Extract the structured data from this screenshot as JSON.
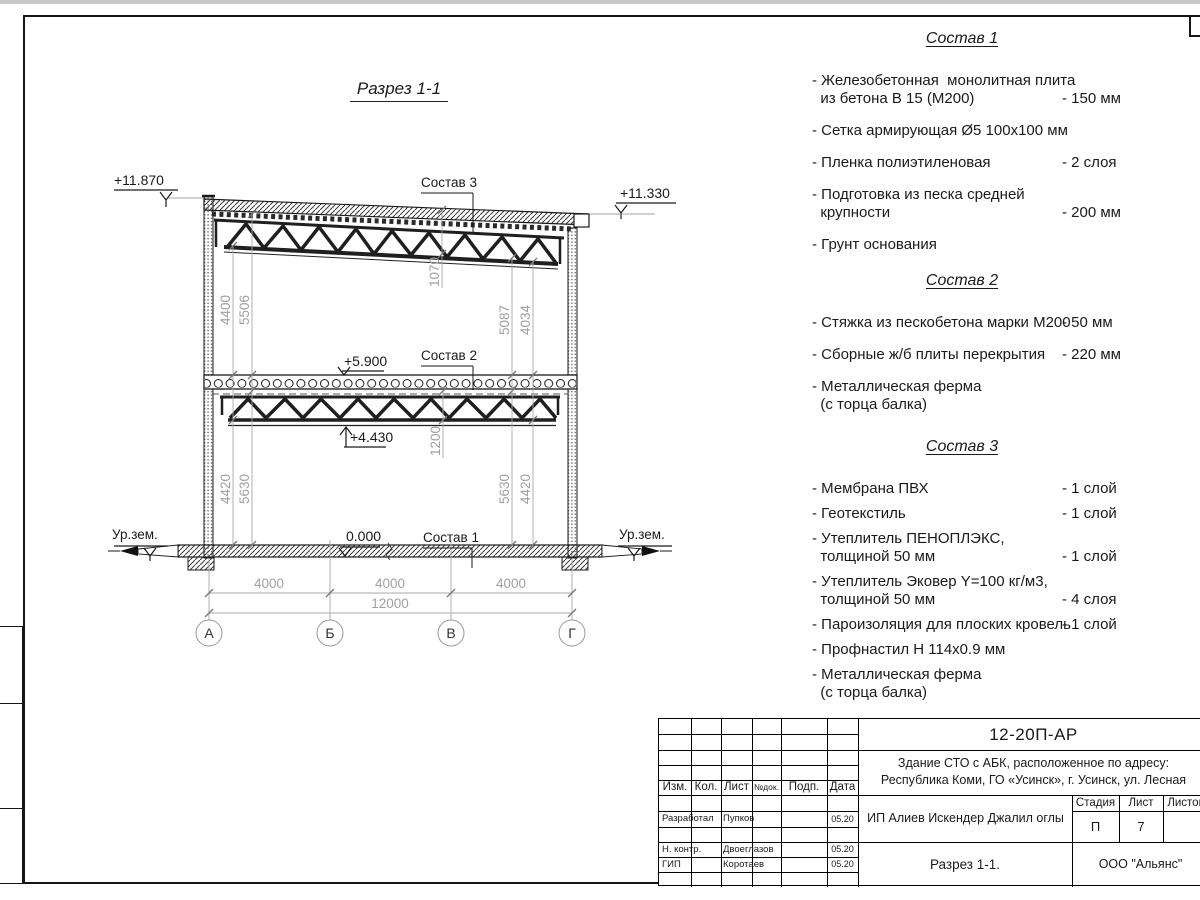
{
  "drawing": {
    "title": "Разрез 1-1",
    "section_labels": {
      "s1": "Состав 1",
      "s2": "Состав 2",
      "s3": "Состав 3"
    },
    "elevations": {
      "roof_left": "+11.870",
      "roof_right": "+11.330",
      "floor2": "+5.900",
      "truss": "+4.430",
      "ground": "0.000",
      "ur_zem_left": "Ур.зем.",
      "ur_zem_right": "Ур.зем."
    },
    "dims": {
      "d4400": "4400",
      "d5506": "5506",
      "d1070": "1070",
      "d5087": "5087",
      "d4034": "4034",
      "d4420_l": "4420",
      "d5630_l": "5630",
      "d1200": "1200",
      "d5630_r": "5630",
      "d4420_r": "4420",
      "span1": "4000",
      "span2": "4000",
      "span3": "4000",
      "total": "12000"
    },
    "axes": [
      "А",
      "Б",
      "В",
      "Г"
    ]
  },
  "compositions": [
    {
      "title": "Состав 1",
      "items": [
        {
          "lines": [
            "- Железобетонная  монолитная плита",
            "из бетона В 15 (М200)"
          ],
          "value": "- 150 мм"
        },
        {
          "lines": [
            "- Сетка армирующая Ø5 100х100 мм"
          ],
          "value": ""
        },
        {
          "lines": [
            "- Пленка полиэтиленовая"
          ],
          "value": "-  2 слоя"
        },
        {
          "lines": [
            "- Подготовка из песка средней",
            "крупности"
          ],
          "value": "- 200 мм"
        },
        {
          "lines": [
            "- Грунт основания"
          ],
          "value": ""
        }
      ]
    },
    {
      "title": "Состав 2",
      "items": [
        {
          "lines": [
            "- Стяжка из пескобетона марки М200"
          ],
          "value": "- 50 мм"
        },
        {
          "lines": [
            "- Сборные ж/б плиты перекрытия"
          ],
          "value": "- 220 мм"
        },
        {
          "lines": [
            "- Металлическая ферма",
            "(с торца балка)"
          ],
          "value": ""
        }
      ]
    },
    {
      "title": "Состав 3",
      "items": [
        {
          "lines": [
            "- Мембрана ПВХ"
          ],
          "value": "- 1 слой"
        },
        {
          "lines": [
            "- Геотекстиль"
          ],
          "value": "- 1 слой"
        },
        {
          "lines": [
            "- Утеплитель ПЕНОПЛЭКС,",
            "толщиной 50 мм"
          ],
          "value": "- 1 слой"
        },
        {
          "lines": [
            "- Утеплитель Эковер Y=100 кг/м3,",
            "толщиной 50 мм"
          ],
          "value": "- 4 слоя"
        },
        {
          "lines": [
            "- Пароизоляция для плоских кровель"
          ],
          "value": "- 1 слой"
        },
        {
          "lines": [
            "- Профнастил Н 114х0.9 мм"
          ],
          "value": ""
        },
        {
          "lines": [
            "- Металлическая ферма",
            "(с торца балка)"
          ],
          "value": ""
        }
      ]
    }
  ],
  "titleblock": {
    "code": "12-20П-АР",
    "project_line1": "Здание СТО с АБК, расположенное по адресу:",
    "project_line2": "Республика Коми, ГО «Усинск», г. Усинск, ул. Лесная",
    "columns": {
      "izm": "Изм.",
      "kol": "Кол.",
      "list": "Лист",
      "ndok": "№док.",
      "podp": "Подп.",
      "data": "Дата"
    },
    "rows": [
      {
        "role": "Разработал",
        "name": "Пупков",
        "date": "05.20"
      },
      {
        "role": "Н. контр.",
        "name": "Двоеглазов",
        "date": "05.20"
      },
      {
        "role": "ГИП",
        "name": "Коротаев",
        "date": "05.20"
      }
    ],
    "stage_label": "Стадия",
    "sheet_label": "Лист",
    "sheets_label": "Листов",
    "stage": "П",
    "sheet": "7",
    "sheets": "",
    "client": "ИП Алиев Искендер Джалил оглы",
    "sheet_title": "Разрез 1-1.",
    "company": "ООО \"Альянс\""
  }
}
